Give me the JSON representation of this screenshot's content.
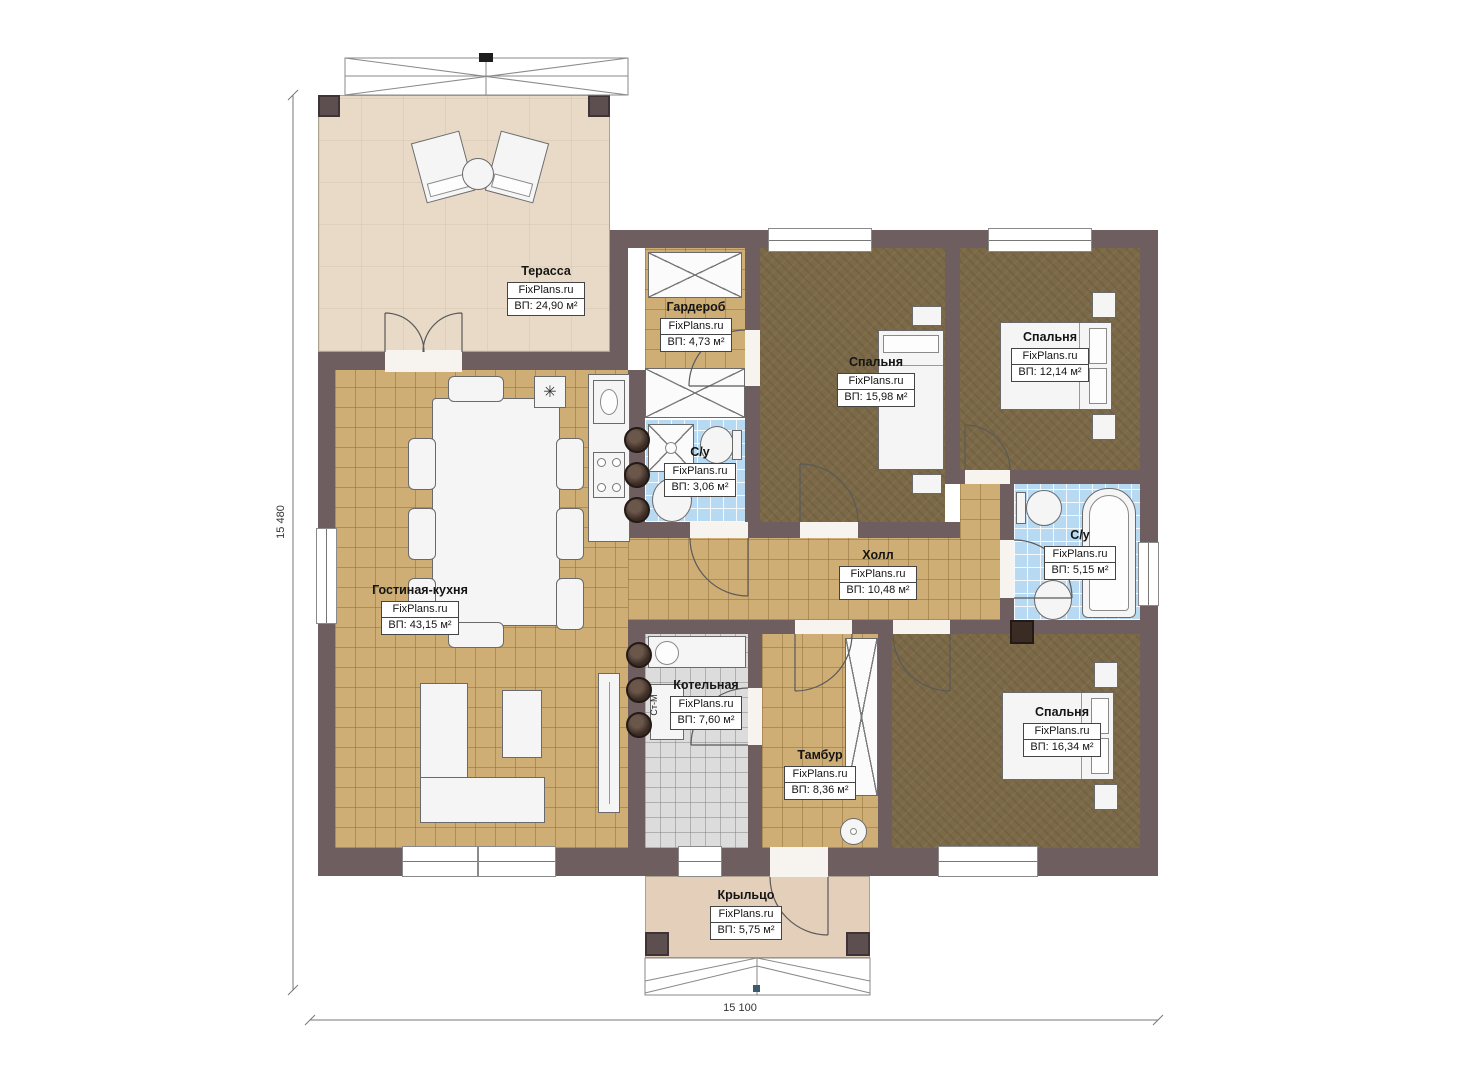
{
  "brand": "FixPlans.ru",
  "rooms": [
    {
      "id": "terrace",
      "name": "Терасса",
      "area": "ВП: 24,90 м²"
    },
    {
      "id": "wardrobe",
      "name": "Гардероб",
      "area": "ВП: 4,73 м²"
    },
    {
      "id": "bedroom-1",
      "name": "Спальня",
      "area": "ВП: 15,98 м²"
    },
    {
      "id": "bedroom-2",
      "name": "Спальня",
      "area": "ВП: 12,14 м²"
    },
    {
      "id": "bathroom-1",
      "name": "С/у",
      "area": "ВП: 3,06 м²"
    },
    {
      "id": "bathroom-2",
      "name": "С/у",
      "area": "ВП: 5,15 м²"
    },
    {
      "id": "hall",
      "name": "Холл",
      "area": "ВП: 10,48 м²"
    },
    {
      "id": "living-kitchen",
      "name": "Гостиная-кухня",
      "area": "ВП: 43,15 м²"
    },
    {
      "id": "boiler-room",
      "name": "Котельная",
      "area": "ВП: 7,60 м²"
    },
    {
      "id": "vestibule",
      "name": "Тамбур",
      "area": "ВП: 8,36 м²"
    },
    {
      "id": "bedroom-3",
      "name": "Спальня",
      "area": "ВП: 16,34 м²"
    },
    {
      "id": "porch",
      "name": "Крыльцо",
      "area": "ВП: 5,75 м²"
    }
  ],
  "dimensions": {
    "left": "15 480",
    "bottom": "15 100"
  },
  "appliances": {
    "washer": "Ст-М"
  },
  "icons": {
    "cooker_hood": "✳"
  },
  "colors": {
    "wall": "#6e5e5f",
    "floor_tan": "#cfae76",
    "floor_dark": "#7b6947",
    "floor_blue": "#b7d9f1",
    "floor_gray": "#dcdcdc",
    "terrace": "#e8dac6",
    "porch": "#e3cfba"
  }
}
